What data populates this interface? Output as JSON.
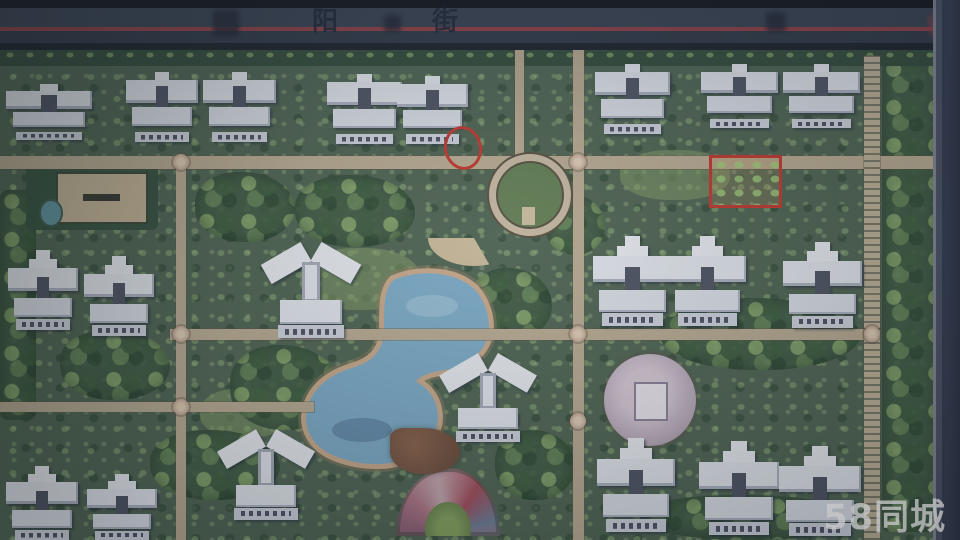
{
  "photo": {
    "watermark_text": "58同城"
  },
  "street": {
    "name_glyphs": [
      "阳",
      "街"
    ]
  },
  "palette": {
    "road": "#343e51",
    "road_red_line": "#a23b3e",
    "ground_green": "#4a6350",
    "path_tan": "#b6a78c",
    "lake_water": "#74a9c9",
    "lake_sand_edge": "#c7a584",
    "building_white": "#dde2ea",
    "building_core": "#4a5163",
    "plaza_lavender": "#b3a3b5",
    "annotation_red": "#cc3328",
    "watermark_white": "#ffffff"
  },
  "map": {
    "buildings": [
      {
        "x": 6,
        "y": 84,
        "w": 86,
        "h": 56,
        "type": "slab"
      },
      {
        "x": 126,
        "y": 72,
        "w": 72,
        "h": 70,
        "type": "slab"
      },
      {
        "x": 203,
        "y": 72,
        "w": 73,
        "h": 70,
        "type": "slab"
      },
      {
        "x": 327,
        "y": 74,
        "w": 75,
        "h": 70,
        "type": "slab"
      },
      {
        "x": 397,
        "y": 76,
        "w": 71,
        "h": 68,
        "type": "slab"
      },
      {
        "x": 595,
        "y": 64,
        "w": 75,
        "h": 70,
        "type": "slab"
      },
      {
        "x": 701,
        "y": 64,
        "w": 77,
        "h": 64,
        "type": "slab"
      },
      {
        "x": 783,
        "y": 64,
        "w": 77,
        "h": 64,
        "type": "slab"
      },
      {
        "x": 8,
        "y": 250,
        "w": 70,
        "h": 80,
        "type": "tower"
      },
      {
        "x": 84,
        "y": 256,
        "w": 70,
        "h": 80,
        "type": "tower"
      },
      {
        "x": 268,
        "y": 248,
        "w": 86,
        "h": 90,
        "type": "butterfly"
      },
      {
        "x": 593,
        "y": 236,
        "w": 79,
        "h": 90,
        "type": "tower"
      },
      {
        "x": 669,
        "y": 236,
        "w": 77,
        "h": 90,
        "type": "tower"
      },
      {
        "x": 783,
        "y": 242,
        "w": 79,
        "h": 86,
        "type": "tower"
      },
      {
        "x": 446,
        "y": 360,
        "w": 84,
        "h": 82,
        "type": "butterfly"
      },
      {
        "x": 6,
        "y": 466,
        "w": 72,
        "h": 74,
        "type": "tower"
      },
      {
        "x": 87,
        "y": 474,
        "w": 70,
        "h": 66,
        "type": "tower"
      },
      {
        "x": 224,
        "y": 436,
        "w": 84,
        "h": 84,
        "type": "butterfly"
      },
      {
        "x": 597,
        "y": 438,
        "w": 78,
        "h": 94,
        "type": "tower"
      },
      {
        "x": 699,
        "y": 441,
        "w": 80,
        "h": 94,
        "type": "tower"
      },
      {
        "x": 779,
        "y": 446,
        "w": 82,
        "h": 90,
        "type": "tower"
      }
    ],
    "paths": [
      {
        "x": 0,
        "y": 156,
        "w": 940,
        "h": 13,
        "style": "plain"
      },
      {
        "x": 170,
        "y": 329,
        "w": 700,
        "h": 11,
        "style": "plain"
      },
      {
        "x": 0,
        "y": 402,
        "w": 314,
        "h": 10,
        "style": "plain"
      },
      {
        "x": 176,
        "y": 156,
        "w": 10,
        "h": 384,
        "style": "plain"
      },
      {
        "x": 573,
        "y": 46,
        "w": 11,
        "h": 494,
        "style": "plain"
      },
      {
        "x": 515,
        "y": 46,
        "w": 9,
        "h": 112,
        "style": "plain"
      },
      {
        "x": 864,
        "y": 56,
        "w": 16,
        "h": 484,
        "style": "ladder"
      }
    ],
    "nodes": [
      {
        "x": 181,
        "y": 162
      },
      {
        "x": 181,
        "y": 334
      },
      {
        "x": 181,
        "y": 407
      },
      {
        "x": 578,
        "y": 162
      },
      {
        "x": 578,
        "y": 334
      },
      {
        "x": 578,
        "y": 421
      },
      {
        "x": 872,
        "y": 334
      }
    ],
    "annotations": [
      {
        "shape": "ellipse",
        "x": 444,
        "y": 126,
        "w": 32,
        "h": 38,
        "rot": -12
      },
      {
        "shape": "rect",
        "x": 709,
        "y": 155,
        "w": 67,
        "h": 47,
        "rot": 0
      }
    ]
  }
}
